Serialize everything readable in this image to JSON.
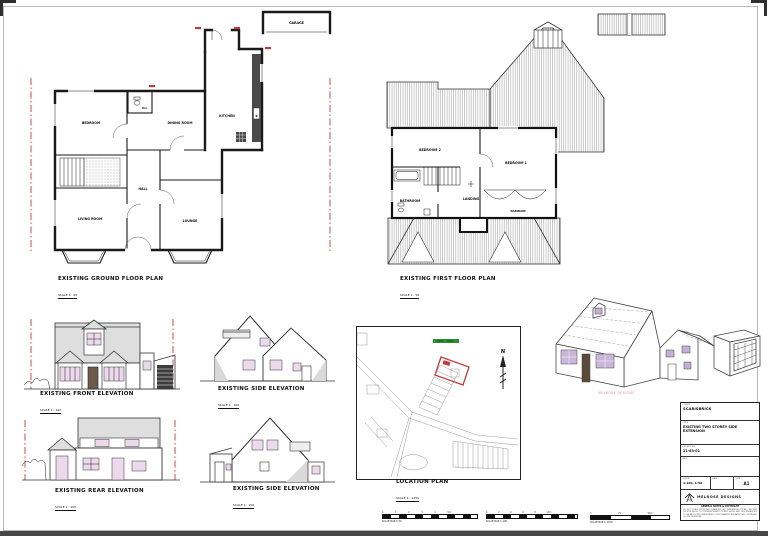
{
  "plans": {
    "ground": {
      "caption": "EXISTING GROUND FLOOR PLAN",
      "scale": "SCALE 1 : 50",
      "rooms": {
        "bedroom": "BEDROOM",
        "dining": "DINING ROOM",
        "kitchen": "KITCHEN",
        "wc": "W.C.",
        "hall": "HALL",
        "living": "LIVING ROOM",
        "lounge": "LOUNGE",
        "garage": "GARAGE"
      }
    },
    "first": {
      "caption": "EXISTING FIRST FLOOR PLAN",
      "scale": "SCALE 1 : 50",
      "rooms": {
        "bedroom2": "BEDROOM 2",
        "bedroom1": "BEDROOM 1",
        "bathroom": "BATHROOM",
        "landing": "LANDING",
        "wardrobe": "WARDROBE"
      }
    }
  },
  "elevations": {
    "front": {
      "caption": "EXISTING FRONT ELEVATION",
      "scale": "SCALE 1 : 100"
    },
    "side1": {
      "caption": "EXISTING SIDE ELEVATION",
      "scale": "SCALE 1 : 100"
    },
    "rear": {
      "caption": "EXISTING REAR ELEVATION",
      "scale": "SCALE 1 : 100"
    },
    "side2": {
      "caption": "EXISTING SIDE ELEVATION",
      "scale": "SCALE 1 : 100"
    }
  },
  "location": {
    "caption": "LOCATION PLAN",
    "scale": "SCALE 1 : 1250",
    "north": "N",
    "plot_outline_color": "#c43a3a",
    "highlight_color": "#2e8f2e"
  },
  "watermark": {
    "text": "MELROSE DESIGNS"
  },
  "title_block": {
    "client_label": "CLIENT",
    "client": "SCARISBRICK",
    "title_label": "TITLE",
    "title": "EXISTING TWO STOREY SIDE EXTENSION",
    "project_label": "PROJECT No",
    "project": "21-63-01",
    "rev_label": "REV",
    "scale_label": "SCALE",
    "scale": "1:100, 1:50",
    "date_label": "DATE",
    "size_label": "SIZE",
    "size": "A1",
    "company": "MELROSE DESIGNS",
    "disclaimer_title": "GENERAL NOTES & COPYRIGHT",
    "disclaimer": "DO NOT SCALE FROM THIS DRAWING. ALL DIMENSIONS TO BE CHECKED ON SITE PRIOR TO COMMENCEMENT OF ANY WORK. ANY DISCREPANCIES TO BE REPORTED IMMEDIATELY. THIS DRAWING REMAINS THE COPYRIGHT OF THE DESIGNER."
  },
  "scale_bars": [
    {
      "caption": "SCALE BAR 1:50",
      "ticks": "0 1 2 3 4 5m"
    },
    {
      "caption": "SCALE BAR 1:100",
      "ticks": "0 2 4 6 8 10m"
    },
    {
      "caption": "SCALE BAR 1:1250",
      "ticks": "0 25 50m"
    }
  ]
}
